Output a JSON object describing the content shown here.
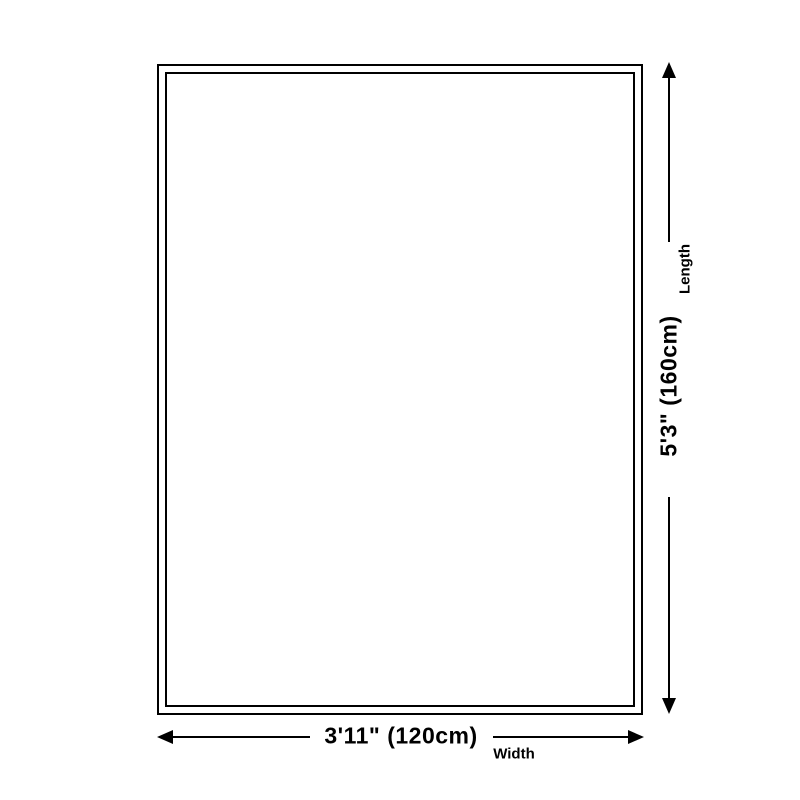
{
  "diagram": {
    "type": "product-dimension-diagram",
    "background_color": "#ffffff",
    "line_color": "#000000",
    "rug_fill_color": "#ffffff",
    "rug_border_style": "double black outline rectangle",
    "length_dimension": {
      "label": "Length",
      "value": "5'3\" (160cm)",
      "orientation": "vertical",
      "side": "right"
    },
    "width_dimension": {
      "label": "Width",
      "value": "3'11\" (120cm)",
      "orientation": "horizontal",
      "side": "bottom"
    },
    "icons": {
      "arrow_up": "arrow-up-icon",
      "arrow_down": "arrow-down-icon",
      "arrow_left": "arrow-left-icon",
      "arrow_right": "arrow-right-icon"
    }
  }
}
